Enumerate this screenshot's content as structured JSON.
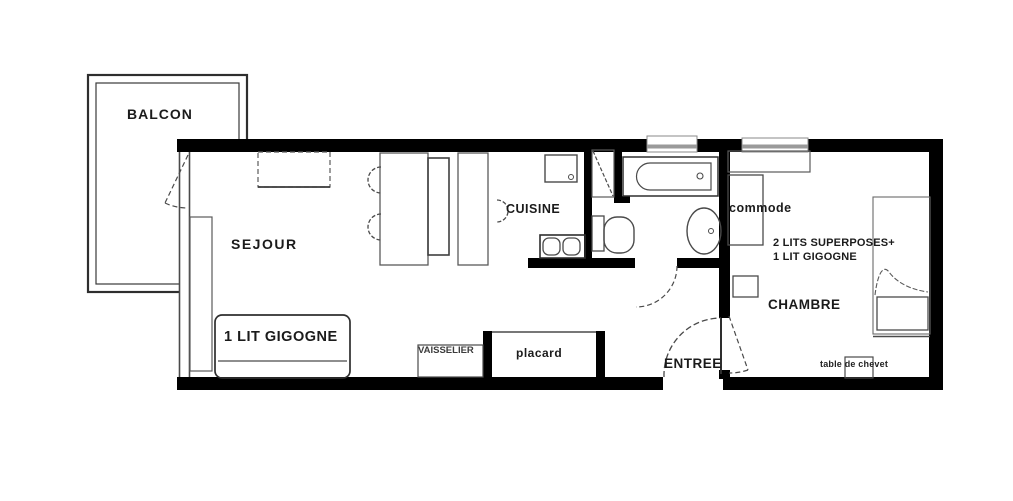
{
  "plan_title": "Apartment floor plan",
  "colors": {
    "wall": "#000000",
    "outline": "#4a4a4a",
    "text": "#1b1b1b",
    "background": "#ffffff"
  },
  "rooms": {
    "balcon": "BALCON",
    "sejour": "SEJOUR",
    "cuisine": "CUISINE",
    "chambre": "CHAMBRE",
    "entree": "ENTREE"
  },
  "furniture": {
    "lit_gigogne": "1 LIT GIGOGNE",
    "vaisselier": "VAISSELIER",
    "placard": "placard",
    "commode": "commode",
    "lits_superposes": "2 LITS SUPERPOSES+",
    "lit_gigogne_chambre": "1 LIT GIGOGNE",
    "table_chevet": "table de chevet"
  }
}
